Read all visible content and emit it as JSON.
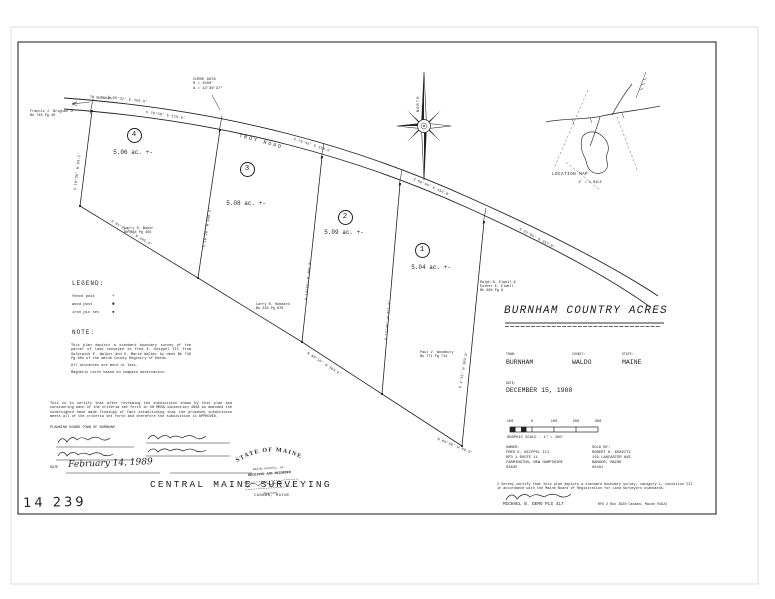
{
  "sheet": {
    "number": "14 239"
  },
  "firm": {
    "name": "CENTRAL MAINE SURVEYING",
    "location": "CANAAN, MAINE"
  },
  "title_block": {
    "title": "BURNHAM COUNTRY ACRES",
    "town_label": "TOWN:",
    "town": "BURNHAM",
    "county_label": "COUNTY:",
    "county": "WALDO",
    "state_label": "STATE:",
    "state": "MAINE",
    "date_label": "DATE:",
    "date": "DECEMBER 15, 1988"
  },
  "scale_bar": {
    "ticks": [
      "100",
      "0",
      "100",
      "200",
      "300"
    ],
    "caption": "GRAPHIC SCALE  -  1\" = 100'"
  },
  "owner": {
    "text": "OWNER:\nFRED E. KEIPPEL III\nRFD 1 ROUTE 11\nFARMINGTON, NEW HAMPSHIRE\n03835"
  },
  "sold_by": {
    "text": "SOLD BY:\nROBERT H. KRAVITZ\n119 LANCASTER AVE.\nBANGOR, MAINE\n04401"
  },
  "surveyor": {
    "certification": "I hereby certify that this plan depicts a standard boundary survey, category 1, condition III in accordance with the Maine Board of Registration for Land Surveyors standards.",
    "name": "MICHAEL N. DEMO   PLS 417",
    "address": "RFD 2 Box 3930 Canaan, Maine 04924"
  },
  "legend": {
    "label": "LEGEND:",
    "items": [
      {
        "label": "fence post",
        "symbol": "+"
      },
      {
        "label": "wood post",
        "symbol": "■"
      },
      {
        "label": "iron pin set",
        "symbol": "●"
      }
    ]
  },
  "note": {
    "label": "NOTE:",
    "body": "This plan depicts a standard boundary survey of the parcel of land conveyed to Fred E. Keippel III from Galbraith E. Walker and E. Marie Walker by deed Bk 749 Pg 683 of the Waldo County Registry of Deeds.",
    "line2": "All distances are more or less.",
    "line3": "Magnetic north based on compass observation."
  },
  "approval": {
    "text": "This is to certify that after reviewing the subdivision shown by this plan and considering each of the criteria set forth in 30 MRSA subsection 4956 as amended the undersigned have made findings of fact establishing that the proposed subdivision meets all of the criteria set forth and therefore the subdivision is APPROVED.",
    "board": "PLANNING BOARD TOWN OF BURNHAM",
    "date_label": "DATE",
    "date": "February 14, 1989"
  },
  "stamp": {
    "arc": "STATE OF MAINE",
    "line1": "Waldo County, ss.",
    "line2": "RECEIVED AND RECORDED",
    "line3": "Register"
  },
  "compass": {
    "label": "NORTH"
  },
  "location_map": {
    "label": "LOCATION MAP",
    "scale": "1\" = 1 MILE"
  },
  "plan": {
    "road": "TROY ROAD",
    "to_label": "TO BURNHAM",
    "curve_data": "CURVE DATA\nR = 1500'\nΔ = 13°30'37\"",
    "lots": [
      {
        "number": "4",
        "acreage": "5.06 ac. +-"
      },
      {
        "number": "3",
        "acreage": "5.08 ac. +-"
      },
      {
        "number": "2",
        "acreage": "5.09 ac. +-"
      },
      {
        "number": "1",
        "acreage": "5.04 ac. +-"
      }
    ],
    "abutters": [
      {
        "text": "Francis J. Brignan Jr.\nBk 746 Pg 40"
      },
      {
        "text": "Larry D. Baker\nBk 764 Pg 456"
      },
      {
        "text": "Larry R. Hubbard\nBk 318 Pg 878"
      },
      {
        "text": "Paul V. Woodbury\nBk 771 Pg 714"
      },
      {
        "text": "Ralph N. Elwell &\nEsther E. Elwell\nBk 668 Pg 8"
      }
    ],
    "bearings": [
      "S 86°32' E  350.9'",
      "S 78°58' E  518.6'",
      "S 75°49' E  310.6'",
      "S 68°40' E  434.0'",
      "S 62°09' E  357.8'",
      "S 10°38' W  93.2'",
      "S 10°28' W  448.3'",
      "S 13°16' W  466.0'",
      "S 12°45' W  477.1'",
      "S 4°15' W  303.9'",
      "S 81°22'55\" W  345.4'",
      "N 80°16' W  383.9'",
      "N 85°30' W  66.0'"
    ]
  }
}
